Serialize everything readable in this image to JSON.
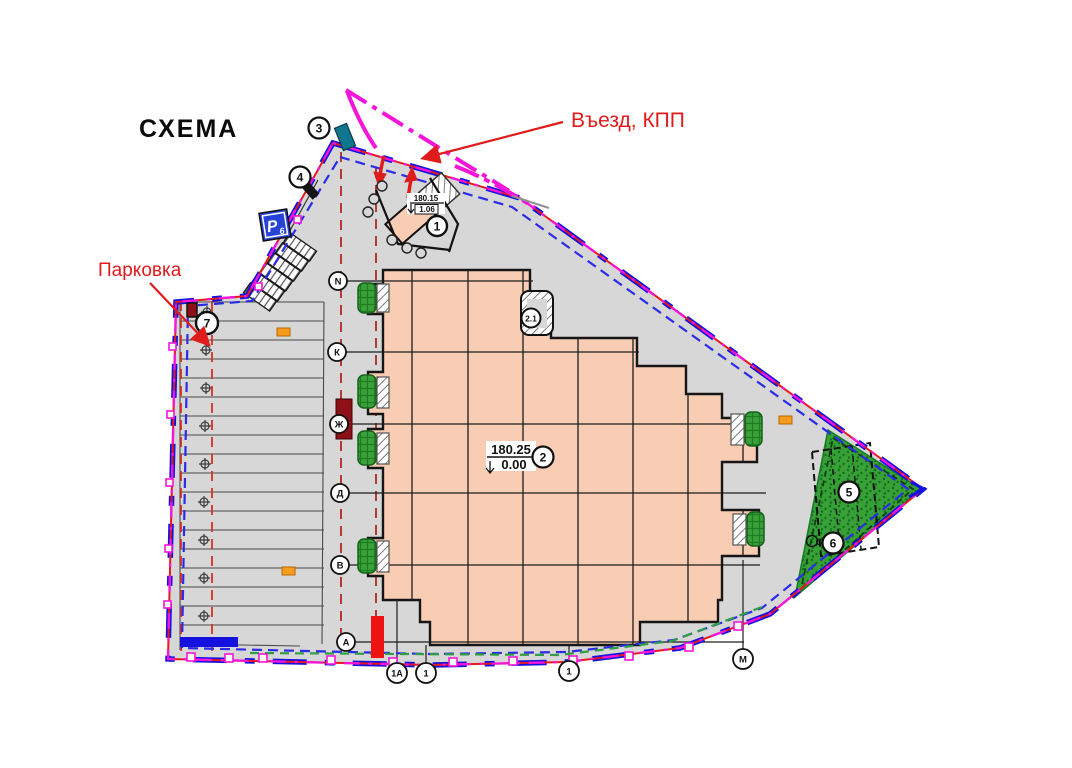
{
  "title": "СХЕМА",
  "annotations": {
    "entrance": "Въезд, КПП",
    "parking": "Парковка"
  },
  "parking_sign": {
    "letter": "Р",
    "index": "6"
  },
  "elevations": {
    "main_top": "180.25",
    "main_bottom": "0.00",
    "kpp_top": "180.15",
    "kpp_bottom": "1.06"
  },
  "callouts": {
    "c1": "1",
    "c2": "2",
    "c21": "2.1",
    "c3": "3",
    "c4": "4",
    "c5": "5",
    "c6": "6",
    "c7": "7"
  },
  "grid": {
    "rows": [
      "N",
      "К",
      "Ж",
      "Д",
      "В",
      "А"
    ],
    "bottom": [
      "1А",
      "1",
      "1",
      "М"
    ],
    "sports_letter": "С"
  },
  "colors": {
    "site_fill": "#d7d7d7",
    "building_fill": "#f8cdb4",
    "boundary_red": "#e51a20",
    "boundary_blue": "#1512df",
    "inner_dashed_blue": "#2b2be8",
    "road_magenta": "#f316d8",
    "green_dashed": "#2f9e45",
    "sports_green": "#37a037",
    "annotation_red": "#e01b1b",
    "orange_marker": "#f59b20",
    "dark_red": "#8c1016",
    "teal": "#12758e"
  }
}
